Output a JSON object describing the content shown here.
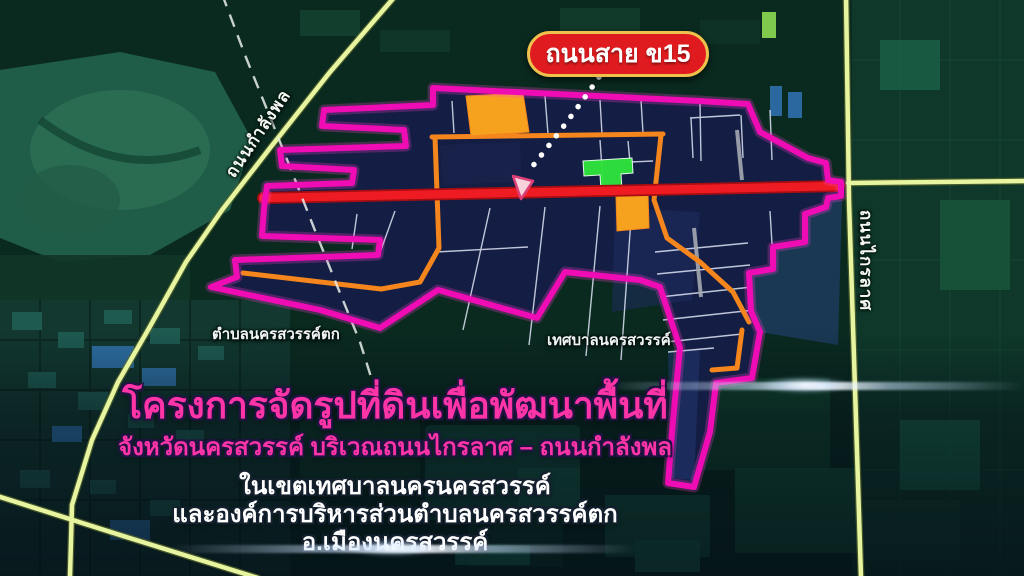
{
  "pill": {
    "label": "ถนนสาย ข15"
  },
  "roads": {
    "left": "ถนนกำลังพล",
    "right": "ถนนไกรลาศ"
  },
  "areas": {
    "left": "ตำบลนครสวรรค์ตก",
    "right": "เทศบาลนครสวรรค์"
  },
  "caption": {
    "title": "โครงการจัดรูปที่ดินเพื่อพัฒนาพื้นที่",
    "subtitle": "จังหวัดนครสวรรค์ บริเวณถนนไกรลาศ – ถนนกำลังพล",
    "line1": "ในเขตเทศบาลนครนครสวรรค์",
    "line2": "และองค์การบริหารส่วนตำบลนครสวรรค์ตก",
    "line3": "อ.เมืองนครสวรรค์"
  },
  "colors": {
    "project_boundary": "#ef0cb4",
    "project_fill": "#141d43",
    "highlight_road_red": "#ee1c22",
    "internal_road_orange": "#f5851d",
    "external_road_yellow": "#e7f4a0",
    "parcel_orange": "#f7a21f",
    "parcel_green": "#2ee33c",
    "title_pink": "#ff34a6",
    "pill_background": "#e01b1f",
    "pill_border": "#eec14d"
  }
}
